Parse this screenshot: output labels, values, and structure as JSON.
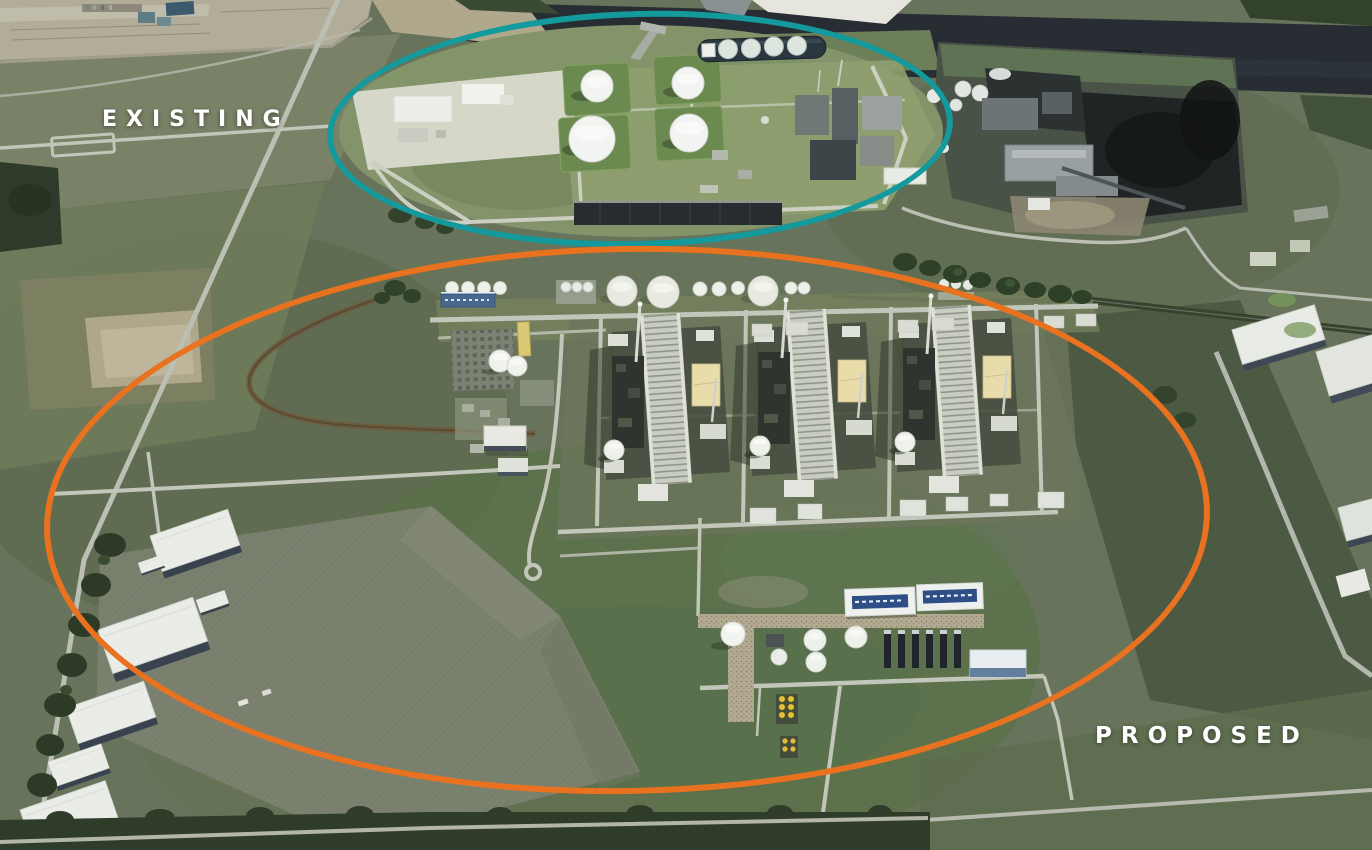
{
  "annotations": {
    "existing": {
      "label": "EXISTING",
      "ring_color": "#14999c",
      "text_color": "#ffffff"
    },
    "proposed": {
      "label": "PROPOSED",
      "ring_color": "#e8721f",
      "text_color": "#ffffff"
    }
  },
  "scene": {
    "setting": "aerial rendering of a riverfront LNG terminal site",
    "existing_facility": {
      "storage_tanks": 4,
      "lng_carrier_at_dock": true
    },
    "proposed_facility": {
      "process_trains": 3,
      "warehouses_southwest": 6
    }
  }
}
